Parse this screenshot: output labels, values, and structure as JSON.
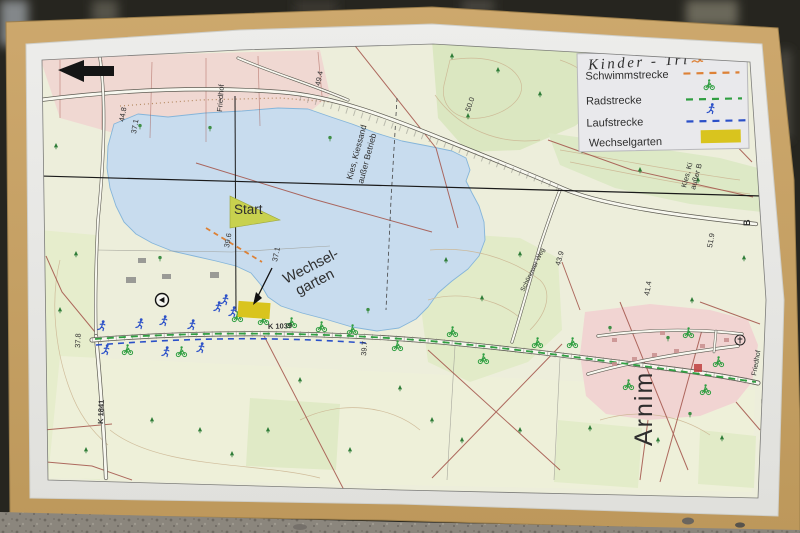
{
  "legend": {
    "title": "Kinder - Tri",
    "items": [
      {
        "label": "Schwimmstrecke",
        "icon": "swimmer-icon",
        "style": "dashed"
      },
      {
        "label": "Radstrecke",
        "icon": "cyclist-icon",
        "style": "dashed"
      },
      {
        "label": "Laufstrecke",
        "icon": "runner-icon",
        "style": "dashed"
      },
      {
        "label": "Wechselgarten",
        "icon": "color-swatch",
        "style": "fill"
      }
    ]
  },
  "map": {
    "start_label": "Start",
    "wechselgarten": {
      "line1": "Wechsel-",
      "line2": "garten"
    },
    "roads": {
      "k1039": "K 1039",
      "k1841": "K 1841",
      "weg": "Schönower Weg"
    },
    "places": {
      "village": "Arnim",
      "cemetery_west": "Friedhof",
      "cemetery_east": "Friedhof"
    },
    "areas": {
      "kies_line1": "Kies, Kiessand",
      "kies_line2": "außer Betrieb",
      "kies_east_line1": "Kies, Ki",
      "kies_east_line2": "außer B"
    },
    "elevations": {
      "e448": "44.8",
      "e494": "49.4",
      "e500": "50.0",
      "e453": "45.3",
      "e396": "39.6",
      "e371": "37.1",
      "e371b": "37.1",
      "e439": "43.9",
      "e397": "39.7",
      "e378": "37.8",
      "e414": "41.4",
      "e519": "51.9"
    },
    "marks": {
      "b1": "B",
      "b2": "B"
    }
  },
  "colors": {
    "swim": "#dd8136",
    "bike": "#2f9e41",
    "run": "#2b50c8",
    "wechselgarten": "#d9c41e"
  }
}
